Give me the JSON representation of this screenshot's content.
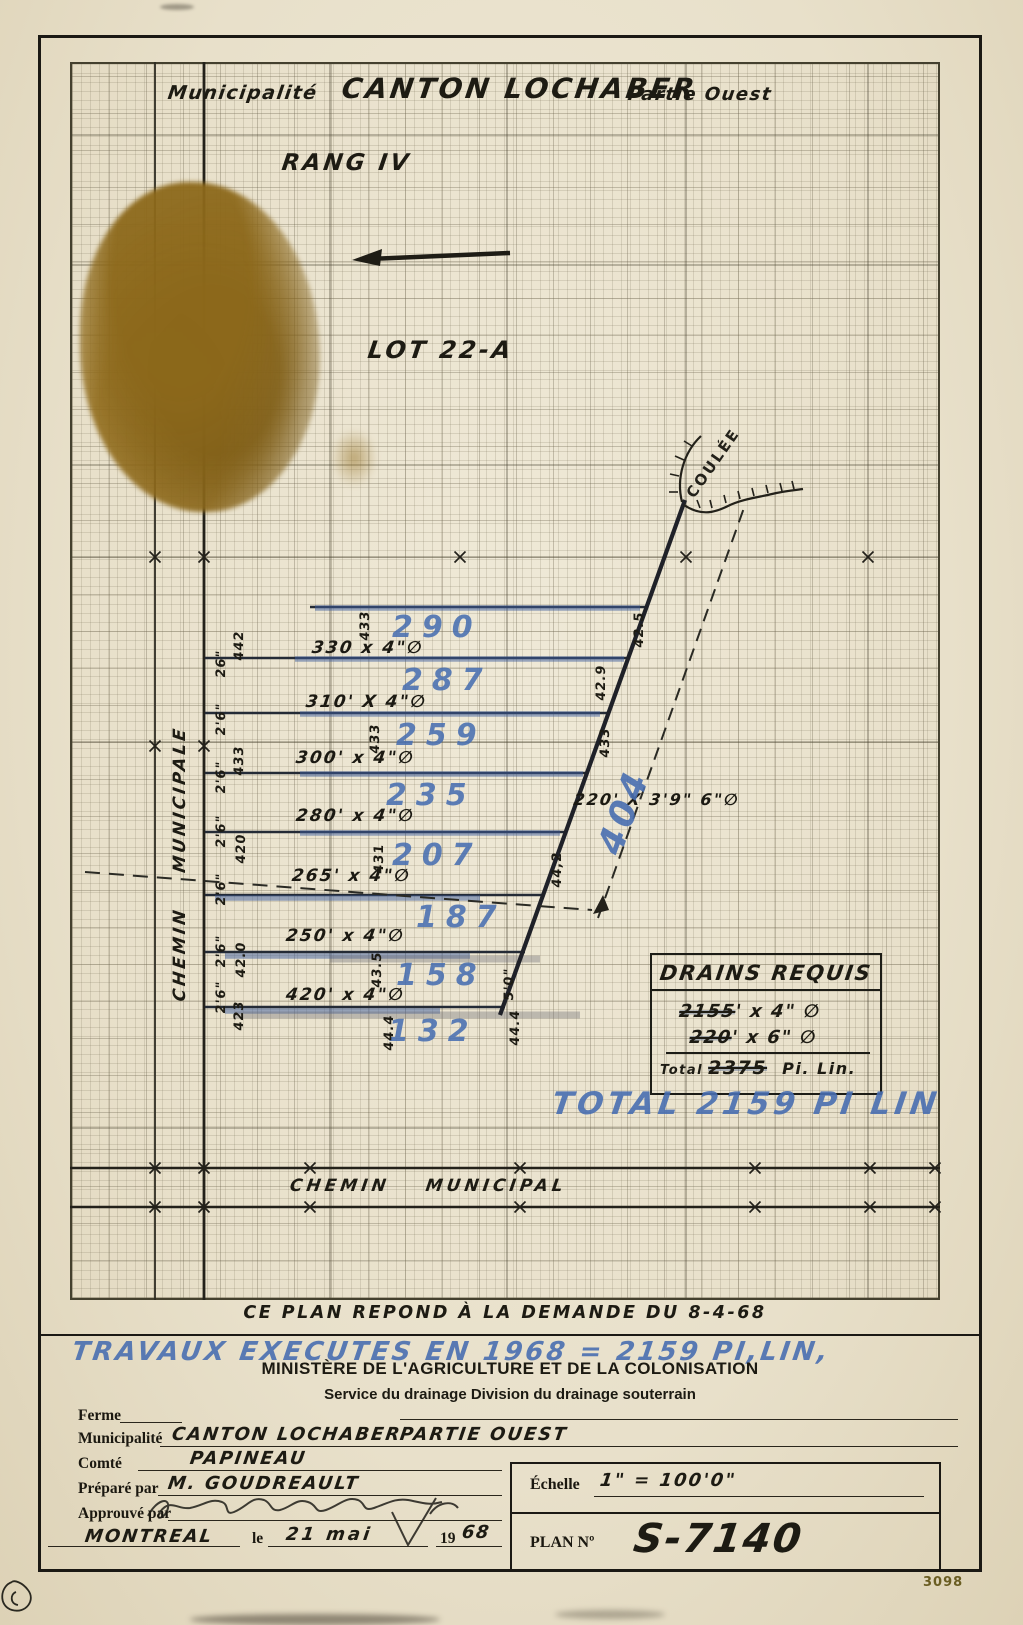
{
  "document": {
    "corner_number": "3098"
  },
  "title": {
    "municipalite_label": "Municipalité",
    "municipality": "CANTON LOCHABER",
    "part": "Partie Ouest",
    "rang": "RANG IV",
    "lot": "LOT 22-A"
  },
  "roads": {
    "left_road": "CHEMIN MUNICIPALE",
    "bottom_road": "CHEMIN MUNICIPAL"
  },
  "coulee": "COULÉE",
  "main_drain": {
    "spec": "220' X 3'9\" 6\"∅",
    "flow": "404"
  },
  "drains": [
    {
      "flow": "290",
      "spec": "330 x 4\"∅",
      "mid_elev": "433",
      "right_elev": "42.5"
    },
    {
      "flow": "287",
      "spec": "310' X 4\"∅",
      "left_depth": "26\"",
      "left_elev": "442",
      "right_elev": "42.9"
    },
    {
      "flow": "259",
      "spec": "300' x 4\"∅",
      "left_depth": "2'6\"",
      "mid_elev": "433",
      "right_elev": "433"
    },
    {
      "flow": "235",
      "spec": "280' x 4\"∅",
      "left_depth": "2'6\"",
      "left_elev": "433"
    },
    {
      "flow": "207",
      "spec": "265' x 4\"∅",
      "left_depth": "2'6\"",
      "left_elev": "420",
      "mid_elev": "431",
      "right_elev": "44,2"
    },
    {
      "flow": "187",
      "spec": "250' x 4\"∅",
      "left_depth": "2'6\""
    },
    {
      "flow": "158",
      "spec": "420' x 4\"∅",
      "left_depth": "2'6\"",
      "left_elev": "42.0",
      "mid_elev": "43.5"
    },
    {
      "flow": "132",
      "left_depth": "2'6\"",
      "left_elev": "423",
      "mid_elev": "44.4",
      "right_elev": "44.4",
      "right_depth": "5'0\""
    }
  ],
  "drains_requis": {
    "title": "DRAINS REQUIS",
    "line1_qty": "2155",
    "line1_spec": "' x 4\" ∅",
    "line2_qty": "220",
    "line2_spec": "' x 6\" ∅",
    "total_label": "Total",
    "total_qty": "2375",
    "total_unit": "Pi. Lin."
  },
  "notes": {
    "total_blue": "TOTAL 2159 PI LIN",
    "demande": "CE PLAN REPOND À LA DEMANDE DU 8-4-68",
    "travaux": "TRAVAUX EXECUTES EN 1968 = 2159 PI,LIN,"
  },
  "ministry": {
    "title": "MINISTÈRE DE L'AGRICULTURE ET DE LA COLONISATION",
    "subtitle": "Service du drainage Division du drainage souterrain"
  },
  "form": {
    "ferme_label": "Ferme",
    "municipalite_label": "Municipalité",
    "municipalite_value": "CANTON LOCHABER",
    "municipalite_value2": "PARTIE OUEST",
    "comte_label": "Comté",
    "comte_value": "PAPINEAU",
    "prepare_label": "Préparé par",
    "prepare_value": "M. GOUDREAULT",
    "approuve_label": "Approuvé par",
    "city": "MONTREAL",
    "le_label": "le",
    "date_value": "21 mai",
    "year_prefix": "19",
    "year_value": "68"
  },
  "scale_box": {
    "echelle_label": "Échelle",
    "echelle_value": "1\" = 100'0\"",
    "plan_label": "PLAN Nº",
    "plan_value": "S-7140"
  },
  "colors": {
    "paper": "#e8e0ca",
    "ink": "#1c1a12",
    "blue": "#486eb0",
    "stain": "#8a6a1e"
  }
}
